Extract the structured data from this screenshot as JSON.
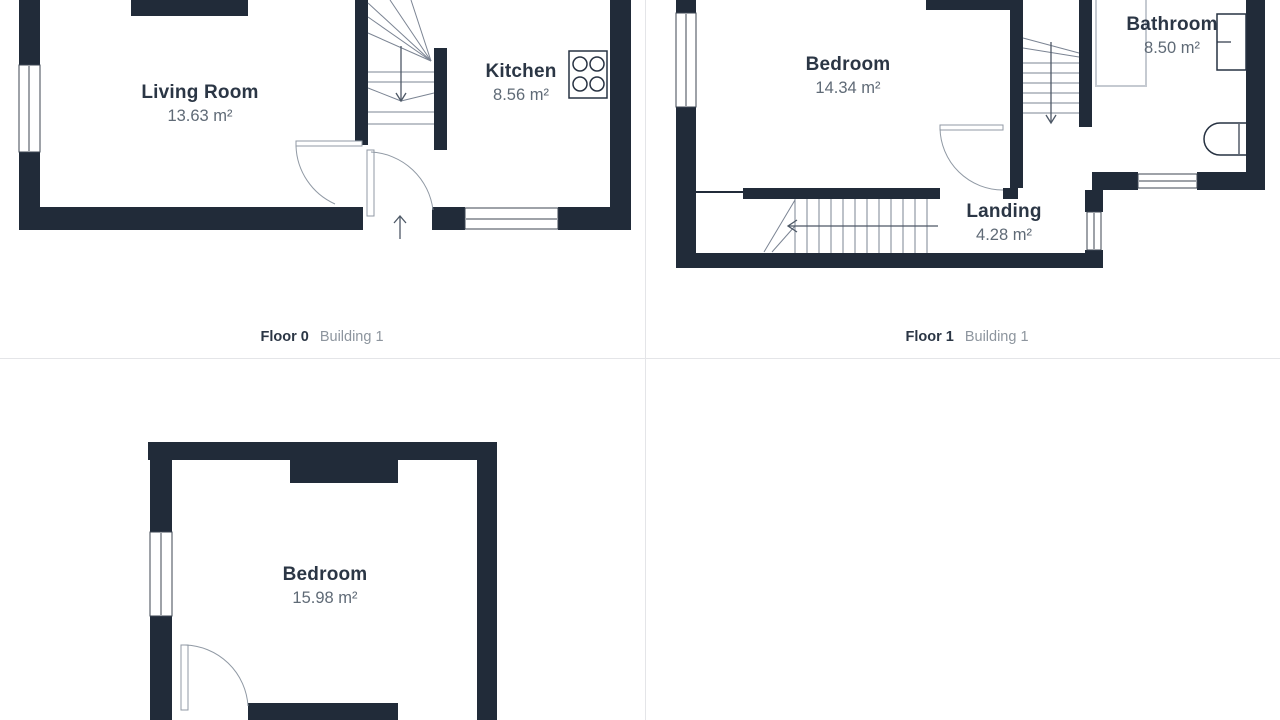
{
  "colors": {
    "background": "#ffffff",
    "wall": "#212b39",
    "room-text": "#2b3645",
    "area-text": "#5f6a76",
    "caption-text": "#2b3645",
    "caption-muted": "#8d959e",
    "divider": "#e4e5e8",
    "door-line": "#9099a4",
    "stair-line": "#7b8493",
    "fixture-line": "#273242",
    "shower-line": "#c5cad1",
    "arrow": "#4d5866"
  },
  "floors": [
    {
      "caption": {
        "floor": "Floor 0",
        "building": "Building 1"
      },
      "rooms": [
        {
          "name": "Living Room",
          "area": "13.63 m²"
        },
        {
          "name": "Kitchen",
          "area": "8.56 m²"
        }
      ],
      "features": [
        "staircase",
        "stove-icon",
        "entry-arrow-icon",
        "door-arcs",
        "windows",
        "chimney-breast"
      ]
    },
    {
      "caption": {
        "floor": "Floor 1",
        "building": "Building 1"
      },
      "rooms": [
        {
          "name": "Bedroom",
          "area": "14.34 m²"
        },
        {
          "name": "Bathroom",
          "area": "8.50 m²"
        },
        {
          "name": "Landing",
          "area": "4.28 m²"
        }
      ],
      "features": [
        "staircase",
        "bathtub-icon",
        "sink-icon",
        "shower-icon",
        "door-arc",
        "windows"
      ]
    },
    {
      "caption": null,
      "rooms": [
        {
          "name": "Bedroom",
          "area": "15.98 m²"
        }
      ],
      "features": [
        "door-arc",
        "window",
        "chimney-breast"
      ]
    }
  ]
}
